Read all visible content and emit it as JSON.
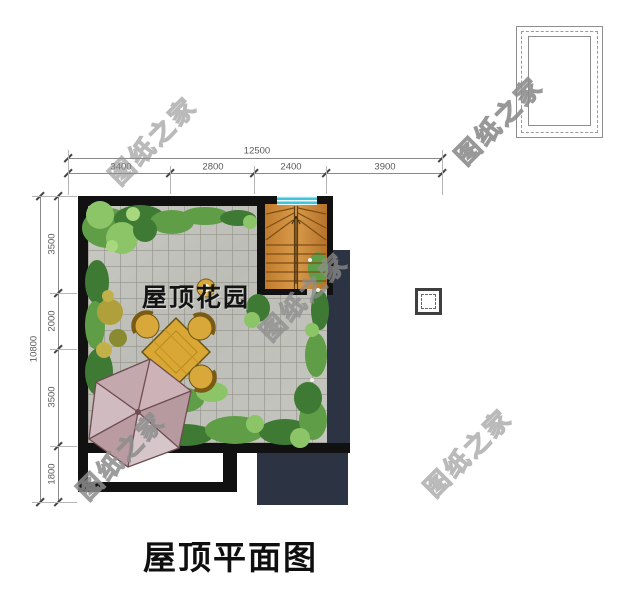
{
  "title": "屋顶平面图",
  "garden": {
    "label": "屋顶花园"
  },
  "watermark": {
    "text": "图纸之家"
  },
  "dimensions": {
    "top": {
      "total": "12500",
      "segments": [
        "3400",
        "2800",
        "2400",
        "3900"
      ]
    },
    "left": {
      "total": "10800",
      "segments": [
        "3500",
        "2000",
        "3500",
        "1800"
      ]
    }
  },
  "colors": {
    "wall": "#111111",
    "charcoal_roof": "#2c3342",
    "paver_gray": "#c4c4be",
    "stair_wood": "#cf8a3a",
    "skylight_cyan": "#49c4d6",
    "umbrella_pink": "#c9adb3",
    "table_gold": "#d9a733",
    "foliage_green": "#5f9e46",
    "watermark_gray": "#8d8d8d"
  }
}
